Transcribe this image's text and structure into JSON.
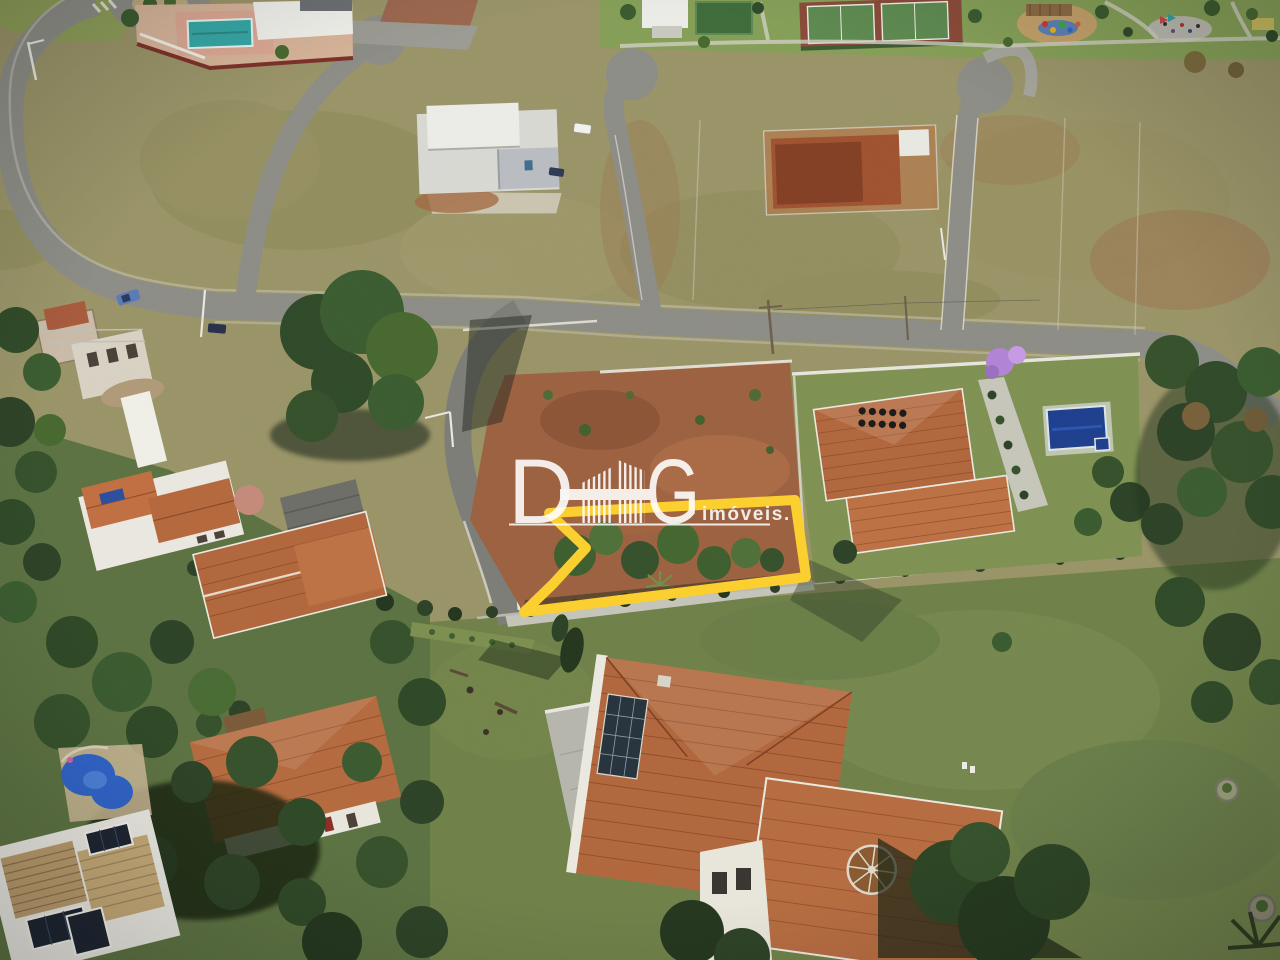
{
  "watermark": {
    "brand": "DHG",
    "brand_d": "D",
    "brand_g": "G",
    "tagline": "imóveis.",
    "glyph": "striped-house-h-icon",
    "color": "#FFFFFF"
  },
  "highlight": {
    "name": "lot-outline-with-arrow",
    "color": "#FBCF2F"
  },
  "palette": {
    "upper_grass": "#9A9468",
    "lower_lawn": "#6F8149",
    "road": "#8D8D87",
    "roof": "#B2673C",
    "pool_blue": "#2F63C8",
    "lap_pool_blue": "#1D3F8E",
    "clubhouse_pool_teal": "#35A7A5",
    "dirt": "#9C6140",
    "tree_dark": "#2F4A28"
  }
}
